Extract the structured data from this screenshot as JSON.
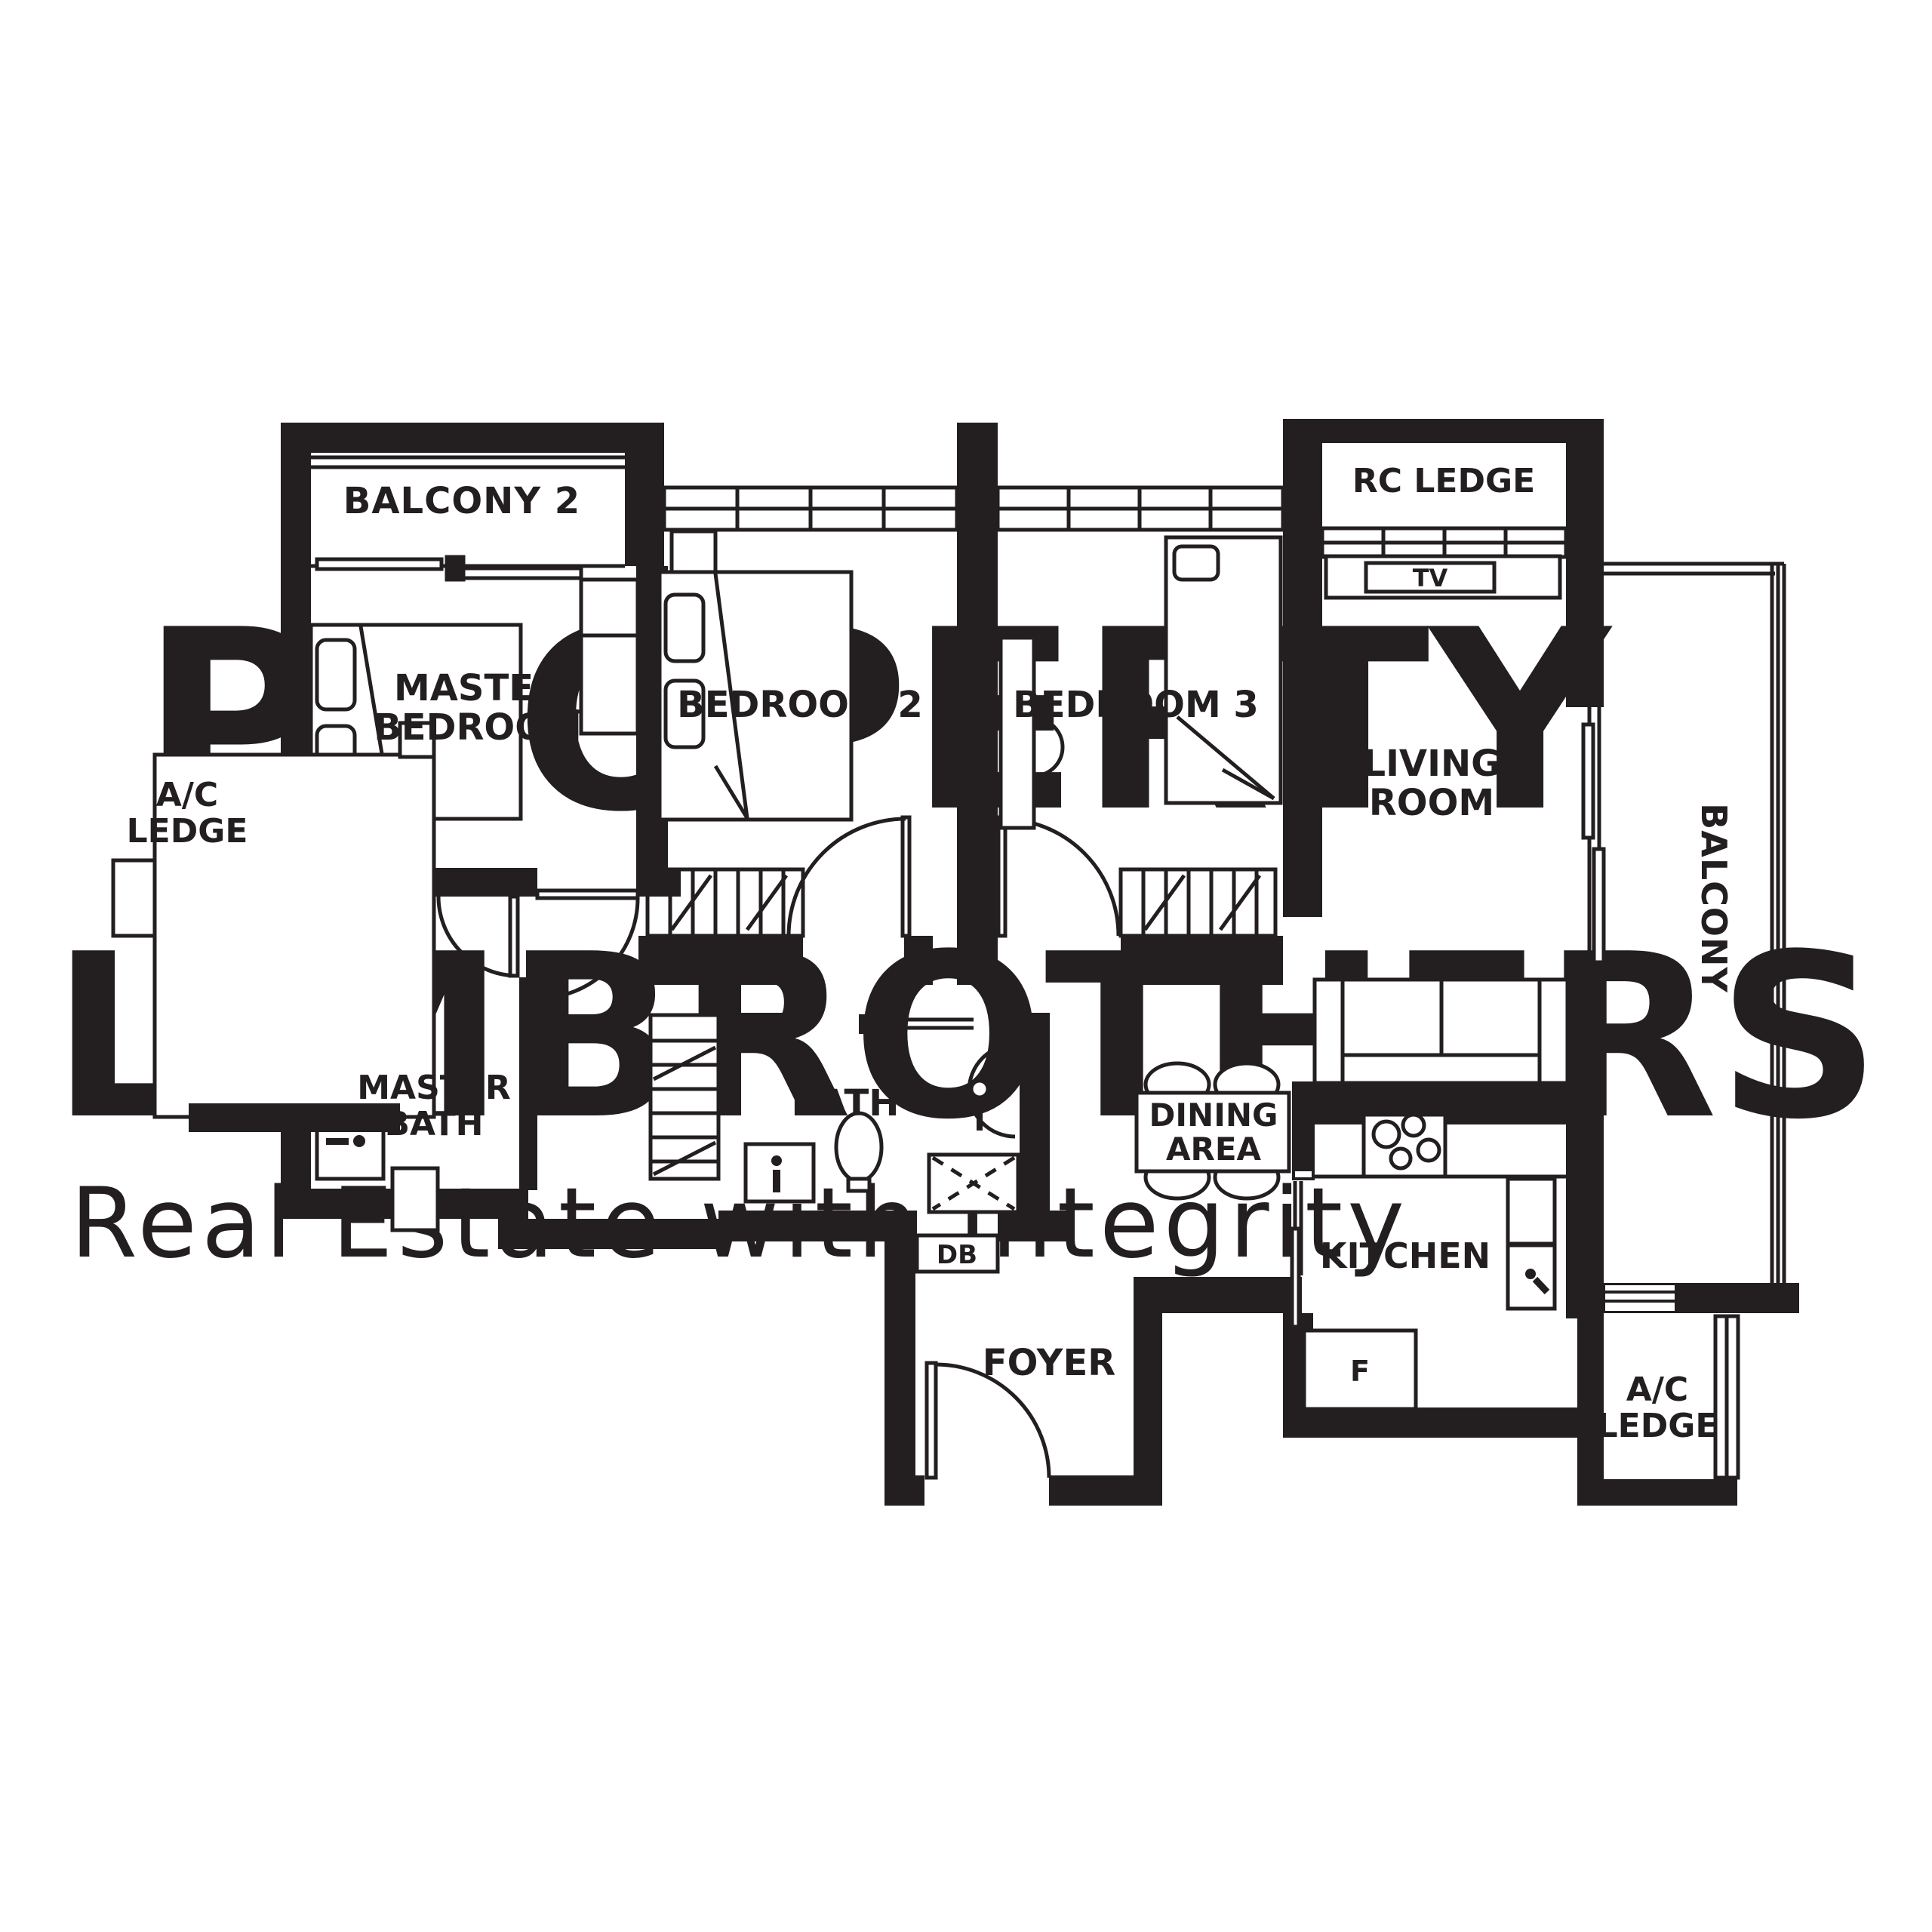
{
  "watermark": {
    "line1": "PROPERTY",
    "line2": "LIMBROTHERS",
    "line3": "Real Estate with Integrity",
    "color_big": "#f3f3f3",
    "color_small": "#f5f4f4"
  },
  "colors": {
    "wall": "#231f20",
    "background": "#ffffff"
  },
  "rooms": {
    "balcony2": {
      "label": "BALCONY 2"
    },
    "master_bedroom": {
      "line1": "MASTER",
      "line2": "BEDROOM"
    },
    "bedroom2": {
      "label": "BEDROOM 2"
    },
    "bedroom3": {
      "label": "BEDROOM 3"
    },
    "rc_ledge": {
      "label": "RC LEDGE"
    },
    "tv": {
      "label": "TV"
    },
    "living_room": {
      "line1": "LIVING",
      "line2": "ROOM"
    },
    "balcony": {
      "label": "BALCONY"
    },
    "ac_ledge_left": {
      "line1": "A/C",
      "line2": "LEDGE"
    },
    "master_bath": {
      "line1": "MASTER",
      "line2": "BATH"
    },
    "bath": {
      "label": "BATH"
    },
    "db": {
      "label": "DB"
    },
    "dining_area": {
      "line1": "DINING",
      "line2": "AREA"
    },
    "kitchen": {
      "label": "KITCHEN"
    },
    "fridge": {
      "label": "F"
    },
    "foyer": {
      "label": "FOYER"
    },
    "ac_ledge_right": {
      "line1": "A/C",
      "line2": "LEDGE"
    }
  }
}
